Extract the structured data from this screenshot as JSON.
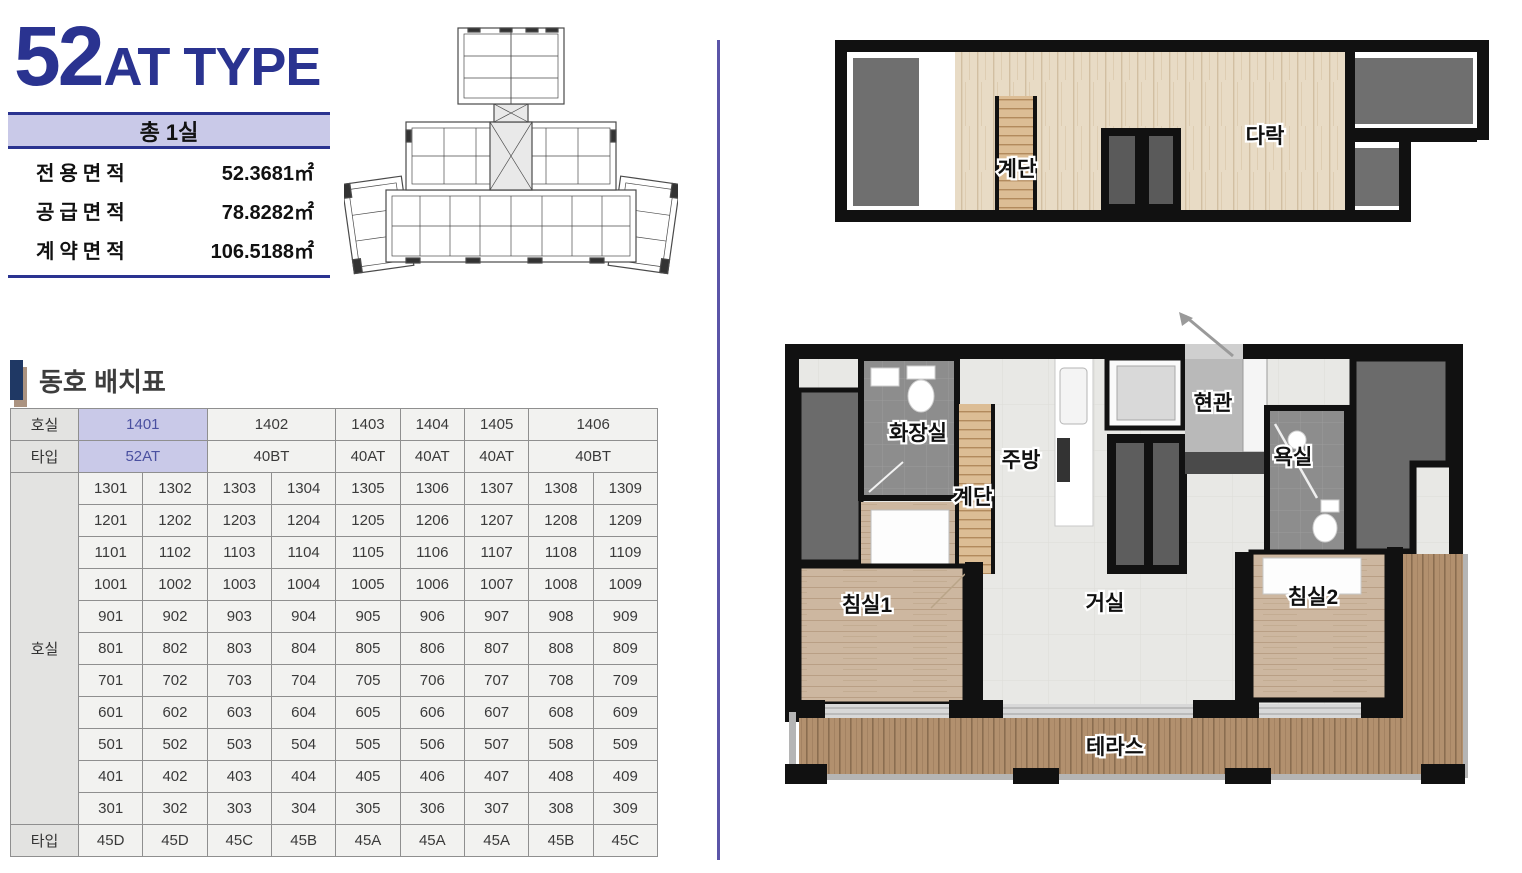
{
  "page": {
    "type_number": "52",
    "type_suffix": "AT TYPE",
    "total_rooms_banner": "총 1실",
    "area_rows": [
      {
        "label": "전용면적",
        "value": "52.3681㎡"
      },
      {
        "label": "공급면적",
        "value": "78.8282㎡"
      },
      {
        "label": "계약면적",
        "value": "106.5188㎡"
      }
    ],
    "section_title": "동호 배치표"
  },
  "colors": {
    "navy": "#2a3390",
    "lavender": "#c9c9e8",
    "highlight_text": "#4a50a0",
    "divider": "#5b55a8",
    "wall": "#111111",
    "room_gray": "#6b6b6b",
    "bath_tile": "#8d8d8d",
    "bedroom_wood": "#cdb7a0",
    "deck_wood": "#b2906e"
  },
  "unit_table": {
    "corner_labels": {
      "room": "호실",
      "type": "타입"
    },
    "header_rooms": [
      {
        "label": "1401",
        "span": 2,
        "highlight": true
      },
      {
        "label": "1402",
        "span": 2,
        "highlight": false
      },
      {
        "label": "1403",
        "span": 1,
        "highlight": false
      },
      {
        "label": "1404",
        "span": 1,
        "highlight": false
      },
      {
        "label": "1405",
        "span": 1,
        "highlight": false
      },
      {
        "label": "1406",
        "span": 2,
        "highlight": false
      }
    ],
    "header_types": [
      {
        "label": "52AT",
        "span": 2,
        "highlight": true
      },
      {
        "label": "40BT",
        "span": 2,
        "highlight": false
      },
      {
        "label": "40AT",
        "span": 1,
        "highlight": false
      },
      {
        "label": "40AT",
        "span": 1,
        "highlight": false
      },
      {
        "label": "40AT",
        "span": 1,
        "highlight": false
      },
      {
        "label": "40BT",
        "span": 2,
        "highlight": false
      }
    ],
    "floor_rows": [
      [
        "1301",
        "1302",
        "1303",
        "1304",
        "1305",
        "1306",
        "1307",
        "1308",
        "1309"
      ],
      [
        "1201",
        "1202",
        "1203",
        "1204",
        "1205",
        "1206",
        "1207",
        "1208",
        "1209"
      ],
      [
        "1101",
        "1102",
        "1103",
        "1104",
        "1105",
        "1106",
        "1107",
        "1108",
        "1109"
      ],
      [
        "1001",
        "1002",
        "1003",
        "1004",
        "1005",
        "1006",
        "1007",
        "1008",
        "1009"
      ],
      [
        "901",
        "902",
        "903",
        "904",
        "905",
        "906",
        "907",
        "908",
        "909"
      ],
      [
        "801",
        "802",
        "803",
        "804",
        "805",
        "806",
        "807",
        "808",
        "809"
      ],
      [
        "701",
        "702",
        "703",
        "704",
        "705",
        "706",
        "707",
        "708",
        "709"
      ],
      [
        "601",
        "602",
        "603",
        "604",
        "605",
        "606",
        "607",
        "608",
        "609"
      ],
      [
        "501",
        "502",
        "503",
        "504",
        "505",
        "506",
        "507",
        "508",
        "509"
      ],
      [
        "401",
        "402",
        "403",
        "404",
        "405",
        "406",
        "407",
        "408",
        "409"
      ],
      [
        "301",
        "302",
        "303",
        "304",
        "305",
        "306",
        "307",
        "308",
        "309"
      ]
    ],
    "bottom_types": [
      "45D",
      "45D",
      "45C",
      "45B",
      "45A",
      "45A",
      "45A",
      "45B",
      "45C"
    ]
  },
  "floor_plans": {
    "attic": {
      "stairs": "계단",
      "attic": "다락"
    },
    "main": {
      "toilet": "화장실",
      "stairs": "계단",
      "kitchen": "주방",
      "entrance": "현관",
      "bathroom": "욕실",
      "bedroom1": "침실1",
      "living": "거실",
      "bedroom2": "침실2",
      "terrace": "테라스"
    }
  }
}
